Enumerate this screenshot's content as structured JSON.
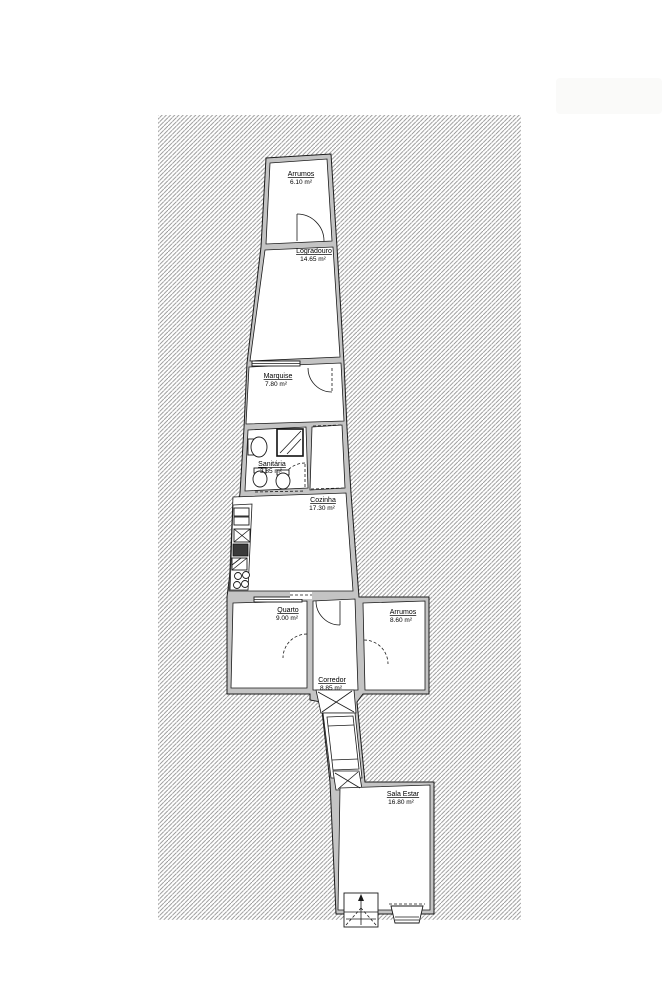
{
  "colors": {
    "hatch_line": "#8f8f8f",
    "wall_fill": "#c4c4c4",
    "line": "#1a1a1a",
    "room_fill": "#ffffff"
  },
  "rooms": {
    "arrumos_top": {
      "name": "Arrumos",
      "area": "6.10 m²"
    },
    "logradouro": {
      "name": "Logradouro",
      "area": "14.65 m²"
    },
    "marquise": {
      "name": "Marquise",
      "area": "7.80 m²"
    },
    "sanitaria": {
      "name": "Sanitária",
      "area": "3.85 m²"
    },
    "cozinha": {
      "name": "Cozinha",
      "area": "17.30 m²"
    },
    "quarto": {
      "name": "Quarto",
      "area": "9.00 m²"
    },
    "arrumos_baixo": {
      "name": "Arrumos",
      "area": "8.60 m²"
    },
    "corredor": {
      "name": "Corredor",
      "area": "8.85 m²"
    },
    "sala_estar": {
      "name": "Sala Estar",
      "area": "16.80 m²"
    }
  }
}
